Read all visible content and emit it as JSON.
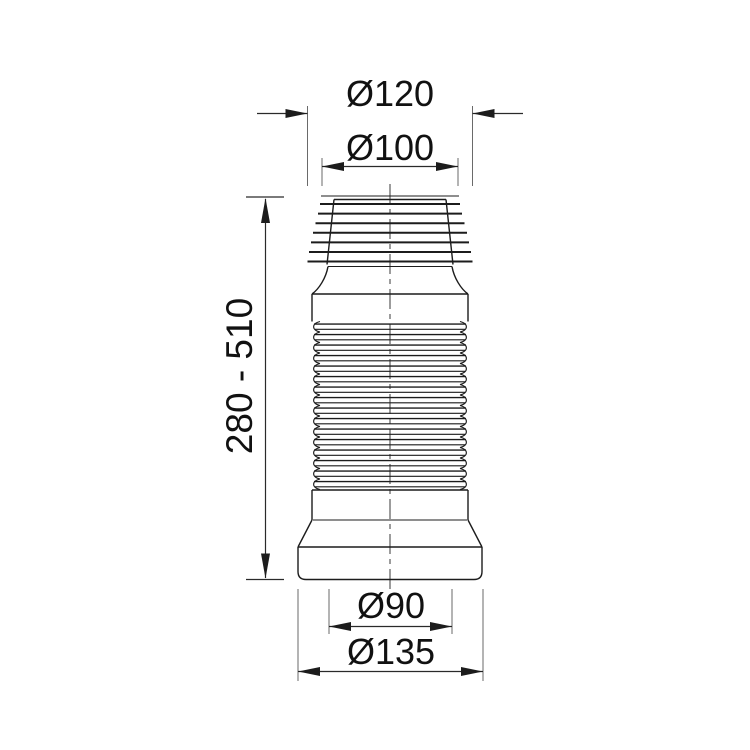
{
  "drawing": {
    "background": "#ffffff",
    "outline_color": "#1c1c1c",
    "dimension_color": "#2a2a2a",
    "labels": {
      "top_outer_diameter": "Ø120",
      "top_inner_diameter": "Ø100",
      "height_range": "280 - 510",
      "bottom_inner_diameter": "Ø90",
      "bottom_outer_diameter": "Ø135"
    }
  }
}
